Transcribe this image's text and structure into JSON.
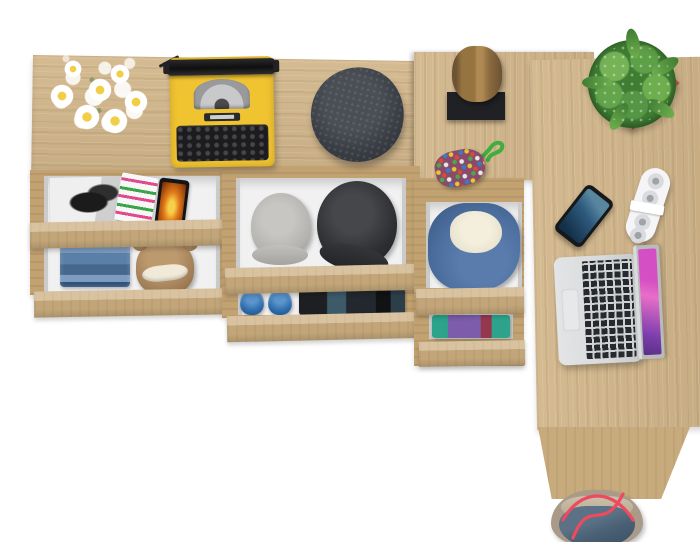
{
  "scene": {
    "title": "Top view of a light-oak corner desk and sideboard with open drawers, accessories and a tote bag",
    "background": "#ffffff"
  },
  "colors": {
    "wood": "#d2b68a",
    "wood_front": "#ccae7f",
    "wood_dark": "#c2a271",
    "wood_panel": "#c8ab7d",
    "drawer_interior": "#f1f1f1",
    "drawer_rail": "#cbcbcb",
    "ty_yellow": "#f0c330",
    "ty_black": "#1c1c1e",
    "beanie": "#3a3e45",
    "log_stand": "#202124",
    "pot": "#b2584a",
    "phone_screen": "#2e5a7d",
    "speaker": "#f5f5f7",
    "laptop_body": "#d7d9db",
    "laptop_keys": "#26292d",
    "screen_pink": "#d44fc4",
    "screen_purple": "#7d3fae",
    "jeans": "#5b80a8",
    "teddy": "#a8845c",
    "cap_gray": "#b5b3af",
    "cap_black": "#2d2f33",
    "shoes": "#2f6fad",
    "hoodie": "#4b6e9e",
    "hoodie_lining": "#eae5d1",
    "teal": "#2da38b",
    "purple": "#7c5cab",
    "maroon": "#95384e",
    "bag_taupe": "#a99a89",
    "bag_blue": "#4a6176",
    "strap_red": "#ef4a5e",
    "mag_pink": "#e24a8e",
    "mag_green": "#3aa544",
    "phone_orange": "#e07818"
  },
  "objects": {
    "sideboard_top": {
      "label": "oak sideboard top"
    },
    "desk_upper": {
      "label": "oak desk upper section"
    },
    "desk_main": {
      "label": "oak desk return surface"
    },
    "desk_side_panel": {
      "label": "desk side panel"
    },
    "flowers": {
      "label": "bouquet of white daisies"
    },
    "typewriter": {
      "label": "yellow vintage typewriter"
    },
    "beanie": {
      "label": "dark gray wool flat cap"
    },
    "log": {
      "label": "decorative wooden log on black stand"
    },
    "pouch": {
      "label": "multicolor bead pouch with green cord"
    },
    "plant": {
      "label": "green succulent in red square pot"
    },
    "smartphone": {
      "label": "smartphone with blue screen"
    },
    "speaker": {
      "label": "white foldable speaker"
    },
    "laptop": {
      "label": "silver laptop with pink wallpaper"
    },
    "magazine_bw": {
      "label": "black and white fashion magazine"
    },
    "magazine_color": {
      "label": "magazine with pink and green cover text"
    },
    "phone_orange": {
      "label": "phone with orange screen"
    },
    "jeans": {
      "label": "folded blue jeans"
    },
    "teddy": {
      "label": "brown teddy bear"
    },
    "cap_gray": {
      "label": "gray cadet cap"
    },
    "cap_black": {
      "label": "black cadet cap"
    },
    "shoes": {
      "label": "pair of blue slip-on shoes"
    },
    "dark_clothes": {
      "label": "folded dark clothes"
    },
    "hoodie": {
      "label": "blue hoodie with fleece lining"
    },
    "clothes_stack": {
      "label": "folded teal and purple clothes"
    },
    "bag": {
      "label": "denim tote bag with red straps"
    }
  }
}
